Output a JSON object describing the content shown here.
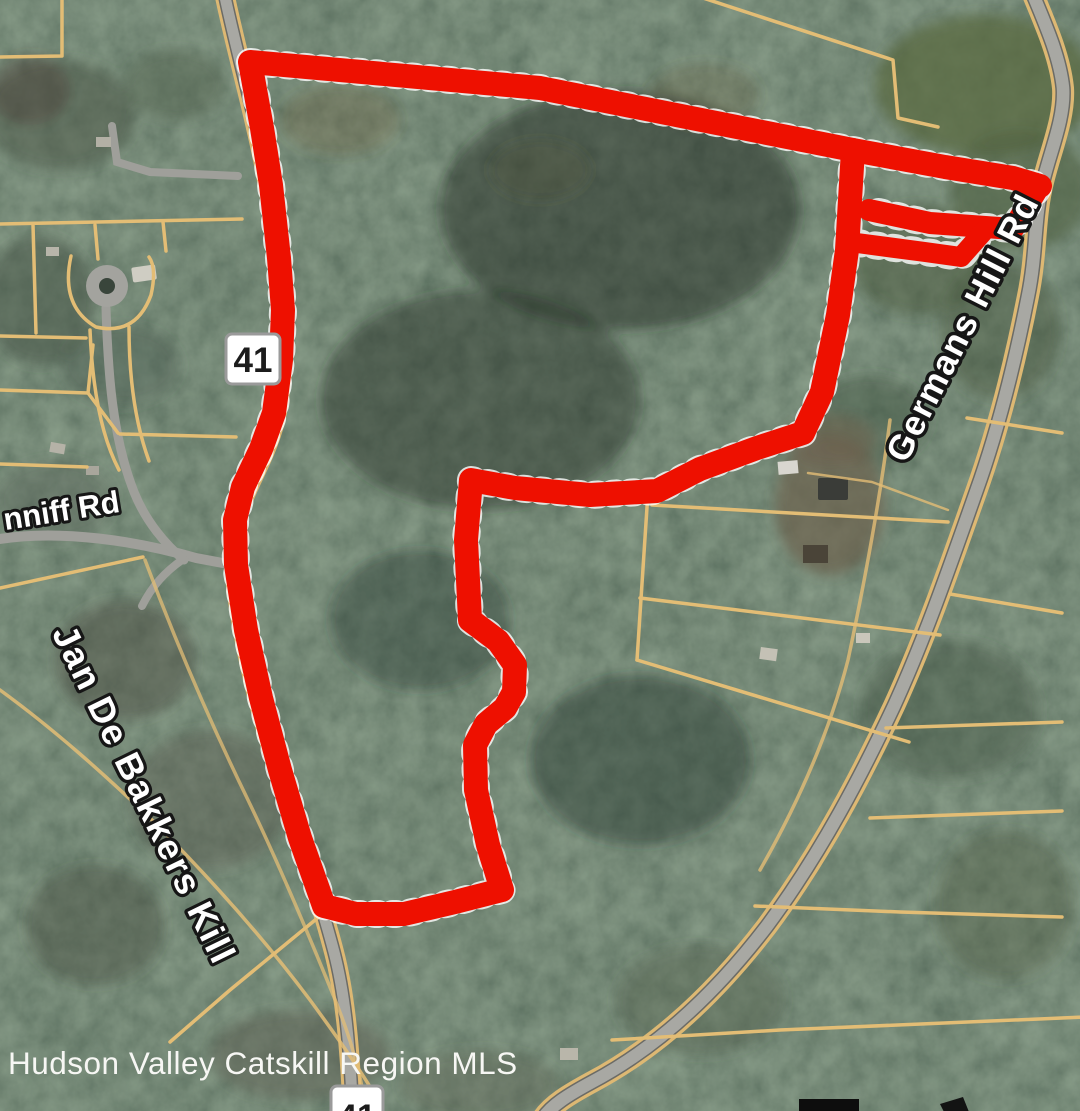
{
  "map": {
    "labels": {
      "route_shield_top": "41",
      "route_shield_bottom": "41",
      "conniff_road": "nniff Rd",
      "germans_hill_road": "Germans Hill Rd",
      "stream": "Jan De Bakkers Kill",
      "watermark": "Hudson Valley Catskill Region MLS"
    },
    "boundary": {
      "color": "#ee1000",
      "fringe_color": "#ffffff"
    },
    "colors": {
      "parcel_line_tan": "#e3bd75",
      "road_gray": "#a8a8a3",
      "road_casing": "#6b6b66",
      "forest_dark": "#2c3a31",
      "field_green": "#5a6a42",
      "shield_fill": "#ffffff",
      "shield_border": "#9a9a9a",
      "label_fill": "#ffffff",
      "label_outline": "#161616"
    }
  }
}
